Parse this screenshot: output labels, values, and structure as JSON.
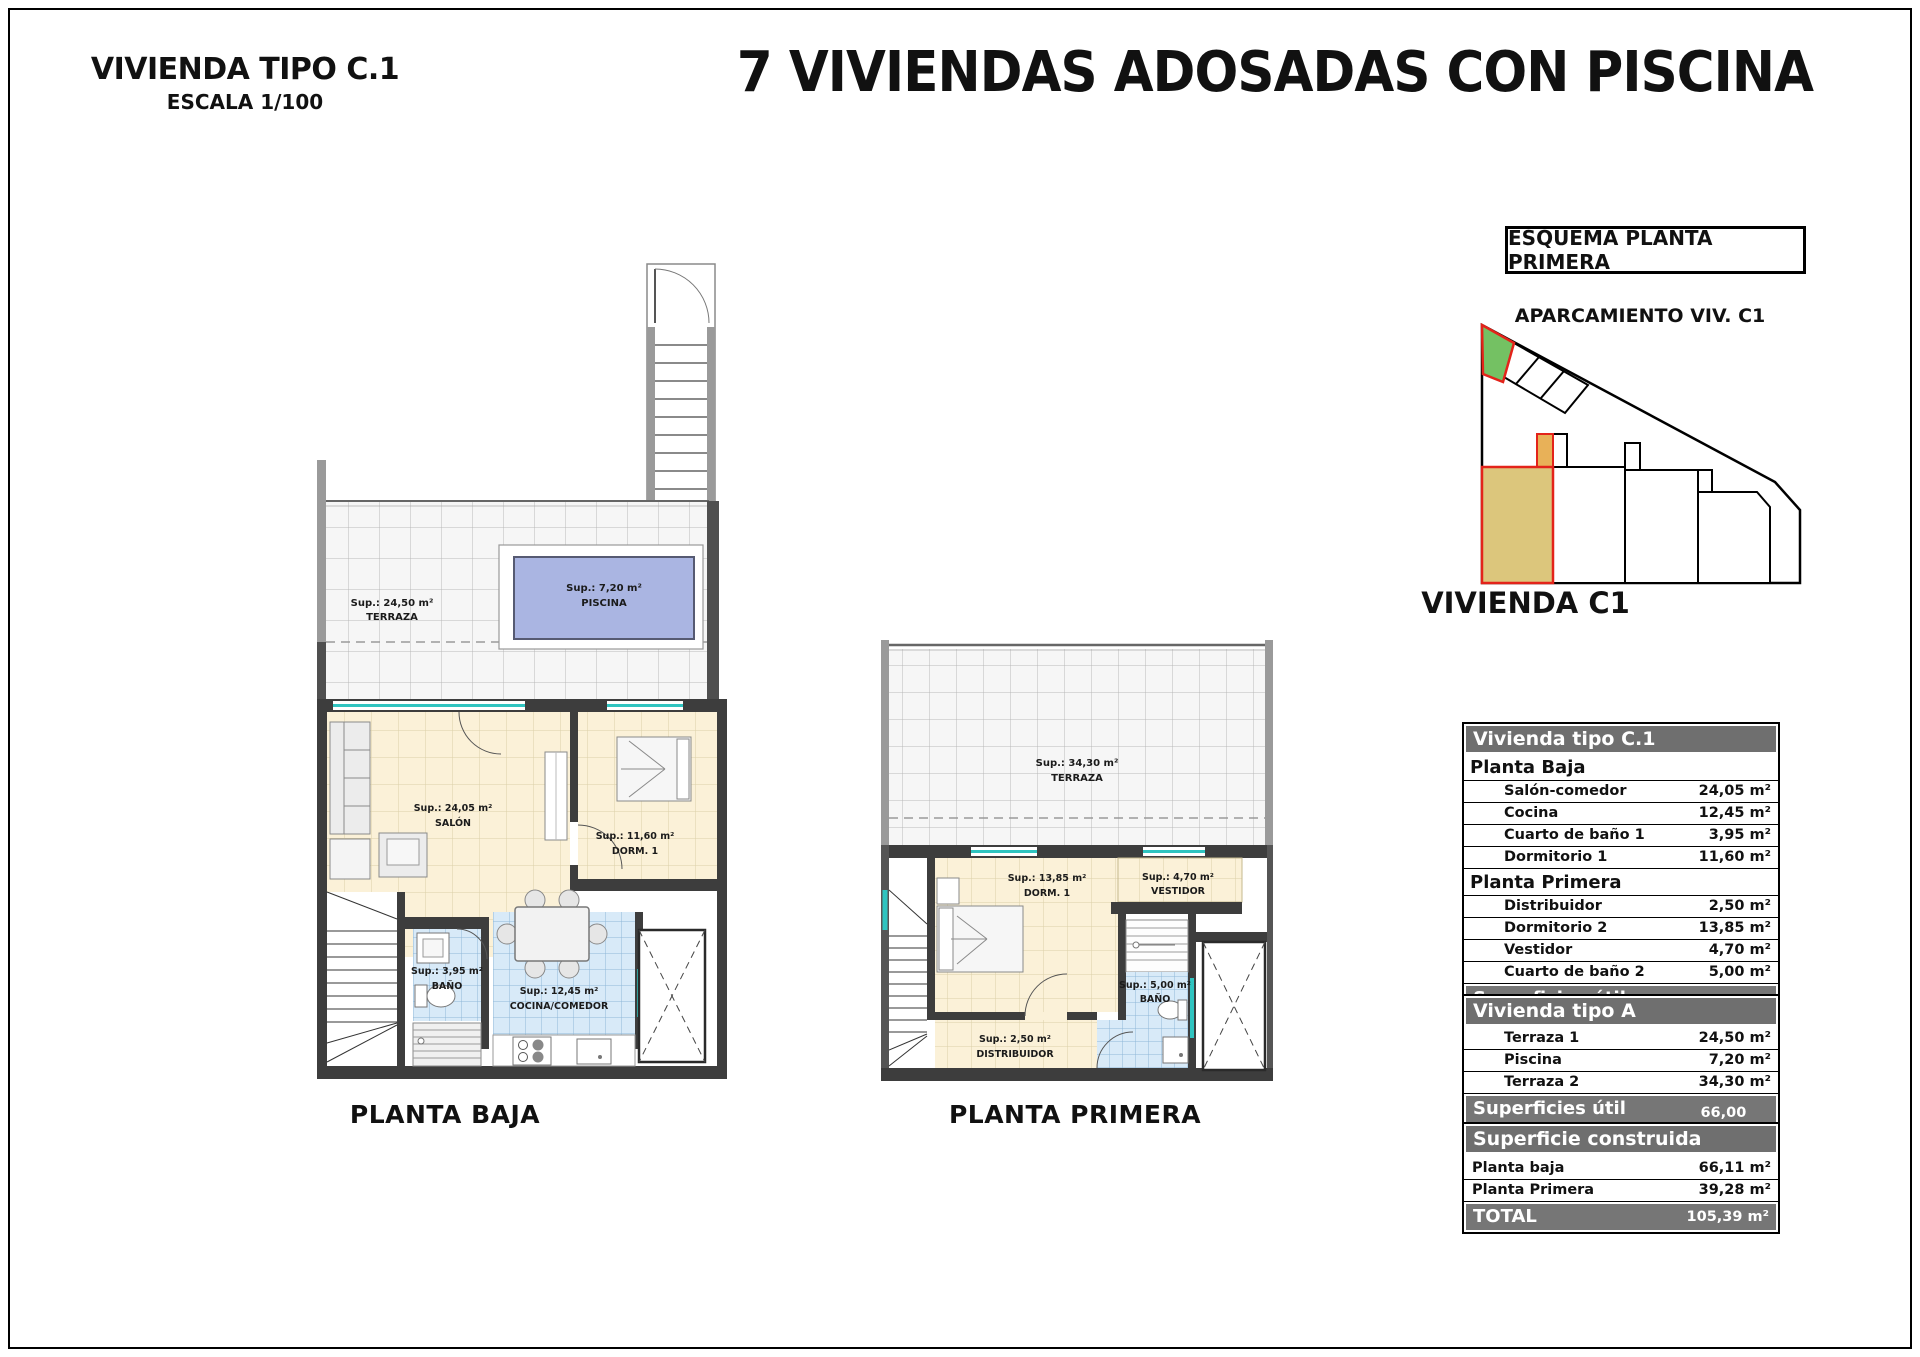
{
  "titles": {
    "drawing_type": "VIVIENDA TIPO C.1",
    "scale": "ESCALA 1/100",
    "main": "7 VIVIENDAS ADOSADAS CON PISCINA"
  },
  "esquema": {
    "box_title": "ESQUEMA PLANTA PRIMERA",
    "parking_label": "APARCAMIENTO VIV. C1",
    "unit_label": "VIVIENDA C1"
  },
  "planta_baja": {
    "caption": "PLANTA BAJA",
    "terraza": {
      "sup": "Sup.: 24,50 m²",
      "name": "TERRAZA"
    },
    "piscina": {
      "sup": "Sup.: 7,20 m²",
      "name": "PISCINA"
    },
    "salon": {
      "sup": "Sup.: 24,05 m²",
      "name": "SALÓN"
    },
    "dormitorio": {
      "sup": "Sup.: 11,60 m²",
      "name": "DORM. 1"
    },
    "bano": {
      "sup": "Sup.: 3,95 m²",
      "name": "BAÑO"
    },
    "cocina": {
      "sup": "Sup.: 12,45 m²",
      "name": "COCINA/COMEDOR"
    }
  },
  "planta_primera": {
    "caption": "PLANTA PRIMERA",
    "terraza": {
      "sup": "Sup.: 34,30 m²",
      "name": "TERRAZA"
    },
    "dormitorio": {
      "sup": "Sup.: 13,85 m²",
      "name": "DORM. 1"
    },
    "vestidor": {
      "sup": "Sup.: 4,70 m²",
      "name": "VESTIDOR"
    },
    "bano": {
      "sup": "Sup.: 5,00 m²",
      "name": "BAÑO"
    },
    "distribuidor": {
      "sup": "Sup.: 2,50 m²",
      "name": "DISTRIBUIDOR"
    }
  },
  "tables": {
    "interior": {
      "title": "Vivienda tipo C.1",
      "sections": [
        {
          "heading": "Planta Baja",
          "rows": [
            [
              "Salón-comedor",
              "24,05 m²"
            ],
            [
              "Cocina",
              "12,45 m²"
            ],
            [
              "Cuarto de baño 1",
              "3,95 m²"
            ],
            [
              "Dormitorio 1",
              "11,60 m²"
            ]
          ]
        },
        {
          "heading": "Planta Primera",
          "rows": [
            [
              "Distribuidor",
              "2,50 m²"
            ],
            [
              "Dormitorio 2",
              "13,85 m²"
            ],
            [
              "Vestidor",
              "4,70 m²"
            ],
            [
              "Cuarto de baño 2",
              "5,00 m²"
            ]
          ]
        }
      ],
      "footer": {
        "label": "Superficies útil interior",
        "value": "78,10 m²"
      }
    },
    "exterior": {
      "title": "Vivienda tipo A",
      "rows": [
        [
          "Terraza 1",
          "24,50 m²"
        ],
        [
          "Piscina",
          "7,20 m²"
        ],
        [
          "Terraza 2",
          "34,30 m²"
        ]
      ],
      "footer": {
        "label": "Superficies útil exterior",
        "value": "66,00 m²"
      }
    },
    "construida": {
      "title": "Superficie construida",
      "rows": [
        [
          "Planta baja",
          "66,11 m²"
        ],
        [
          "Planta Primera",
          "39,28 m²"
        ]
      ],
      "footer": {
        "label": "TOTAL",
        "value": "105,39 m²"
      }
    }
  },
  "colors": {
    "wall": "#3d3d3d",
    "red_outline": "#e3231a",
    "green_parking": "#74c163",
    "tan_unit": "#dcc67c",
    "pool": "#aab5e2",
    "window_teal": "#2fc4c0"
  }
}
